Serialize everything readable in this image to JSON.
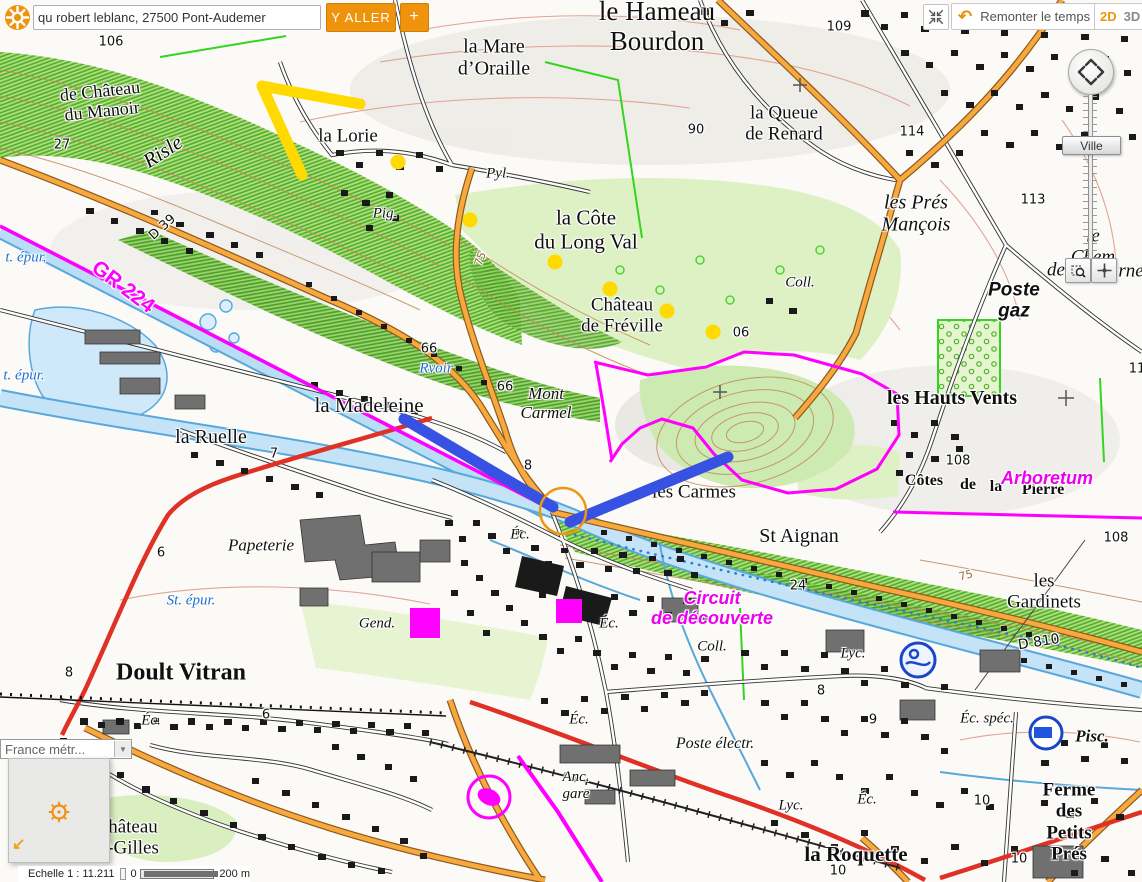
{
  "colors": {
    "accent_orange": "#ef930c",
    "magenta": "#ff00ff",
    "annotation_yellow": "#ffd900",
    "annotation_blue": "#3751e3"
  },
  "search": {
    "value": "qu robert leblanc, 27500 Pont-Audemer",
    "go_label": "Y ALLER",
    "add_label": "+"
  },
  "top_right": {
    "remonter_label": "Remonter le temps",
    "mode_2d": "2D",
    "mode_3d": "3D"
  },
  "zoom_control": {
    "slider_label": "Ville"
  },
  "layer_switcher": {
    "selected": "France métr..."
  },
  "status_bar": {
    "scale_label": "Echelle 1 :  11.211",
    "scale_start": "0",
    "scale_end": "200 m"
  },
  "map": {
    "labels": [
      {
        "text": "le Hameau\nBourdon"
      },
      {
        "text": "la Mare\nd’Oraille"
      },
      {
        "text": "la Queue\nde Renard"
      },
      {
        "text": "les Prés\nMançois"
      },
      {
        "text": "109"
      },
      {
        "text": "90"
      },
      {
        "text": "114"
      },
      {
        "text": "113"
      },
      {
        "text": "106"
      },
      {
        "text": "27"
      },
      {
        "text": "de Château\ndu Manoir"
      },
      {
        "text": "Risle"
      },
      {
        "text": "D 39"
      },
      {
        "text": "la Lorie"
      },
      {
        "text": "Pig."
      },
      {
        "text": "Pyl."
      },
      {
        "text": "la Côte\ndu Long Val"
      },
      {
        "text": "Château\nde Fréville"
      },
      {
        "text": "06"
      },
      {
        "text": "GR 224"
      },
      {
        "text": "t. épur."
      },
      {
        "text": "t. épur."
      },
      {
        "text": "St. épur."
      },
      {
        "text": "la Madeleine"
      },
      {
        "text": "la Ruelle"
      },
      {
        "text": "Rvoir"
      },
      {
        "text": "66"
      },
      {
        "text": "66"
      },
      {
        "text": "Mont\nCarmel"
      },
      {
        "text": "les Carmes"
      },
      {
        "text": "St  Aignan"
      },
      {
        "text": "Côtes"
      },
      {
        "text": "de"
      },
      {
        "text": "la"
      },
      {
        "text": "Pierre"
      },
      {
        "text": "Arboretum"
      },
      {
        "text": "les Hauts Vents"
      },
      {
        "text": "108"
      },
      {
        "text": "108"
      },
      {
        "text": "les Gardinets"
      },
      {
        "text": "D 810"
      },
      {
        "text": "Éc. spéc."
      },
      {
        "text": "Pisc."
      },
      {
        "text": "Ferme\ndes Petits Prés"
      },
      {
        "text": "10"
      },
      {
        "text": "10"
      },
      {
        "text": "10"
      },
      {
        "text": "la Roquette"
      },
      {
        "text": "Lyc."
      },
      {
        "text": "Lyc."
      },
      {
        "text": "Coll."
      },
      {
        "text": "Coll."
      },
      {
        "text": "Éc."
      },
      {
        "text": "Éc."
      },
      {
        "text": "Éc."
      },
      {
        "text": "Éc."
      },
      {
        "text": "Éc."
      },
      {
        "text": "Poste électr."
      },
      {
        "text": "Anc.\ngare"
      },
      {
        "text": "Gend."
      },
      {
        "text": "Papeterie"
      },
      {
        "text": "Doult Vitran"
      },
      {
        "text": "Circuit\nde découverte"
      },
      {
        "text": "hâteau\n-Gilles"
      },
      {
        "text": "Poste\ngaz"
      },
      {
        "text": "le Chem"
      },
      {
        "text": "de"
      },
      {
        "text": "rne"
      },
      {
        "text": "24"
      },
      {
        "text": "8"
      },
      {
        "text": "8"
      },
      {
        "text": "8"
      },
      {
        "text": "6"
      },
      {
        "text": "6"
      },
      {
        "text": "7"
      },
      {
        "text": "9"
      },
      {
        "text": "75"
      },
      {
        "text": "75"
      },
      {
        "text": "11"
      }
    ]
  }
}
